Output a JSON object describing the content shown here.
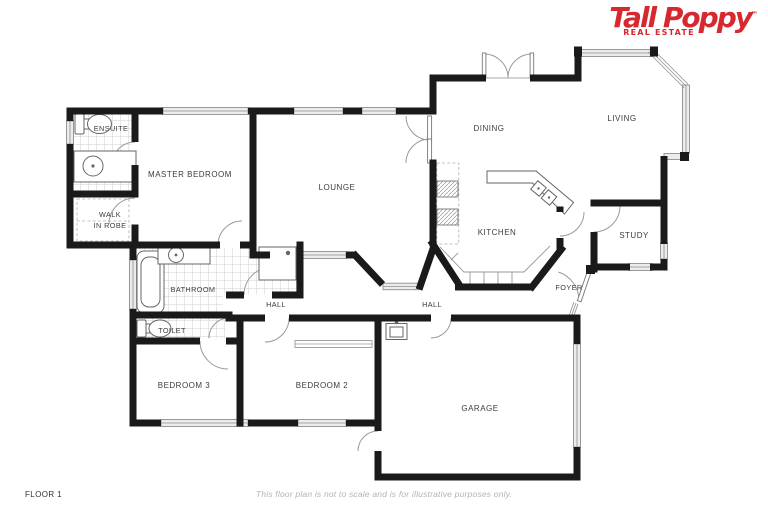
{
  "logo": {
    "name": "Tall Poppy",
    "tm": "™",
    "tagline": "REAL ESTATE",
    "color": "#d7282f"
  },
  "rooms": {
    "ensuite": "ENSUITE",
    "master_bedroom": "MASTER BEDROOM",
    "walk_in_robe_line1": "WALK",
    "walk_in_robe_line2": "IN ROBE",
    "lounge": "LOUNGE",
    "dining": "DINING",
    "living": "LIVING",
    "kitchen": "KITCHEN",
    "study": "STUDY",
    "foyer": "FOYER",
    "bathroom": "BATHROOM",
    "toilet": "TOILET",
    "hall_left": "HALL",
    "hall_right": "HALL",
    "bedroom3": "BEDROOM 3",
    "bedroom2": "BEDROOM 2",
    "garage": "GARAGE"
  },
  "footer": {
    "floor_label": "FLOOR 1",
    "disclaimer": "This floor plan is not to scale and is for illustrative purposes only."
  },
  "colors": {
    "logo_red": "#d7282f",
    "walls": "#1a1a1a",
    "window_fill": "#ececec",
    "label_text": "#3c3c3c",
    "disclaimer_text": "#b3b3b3"
  }
}
